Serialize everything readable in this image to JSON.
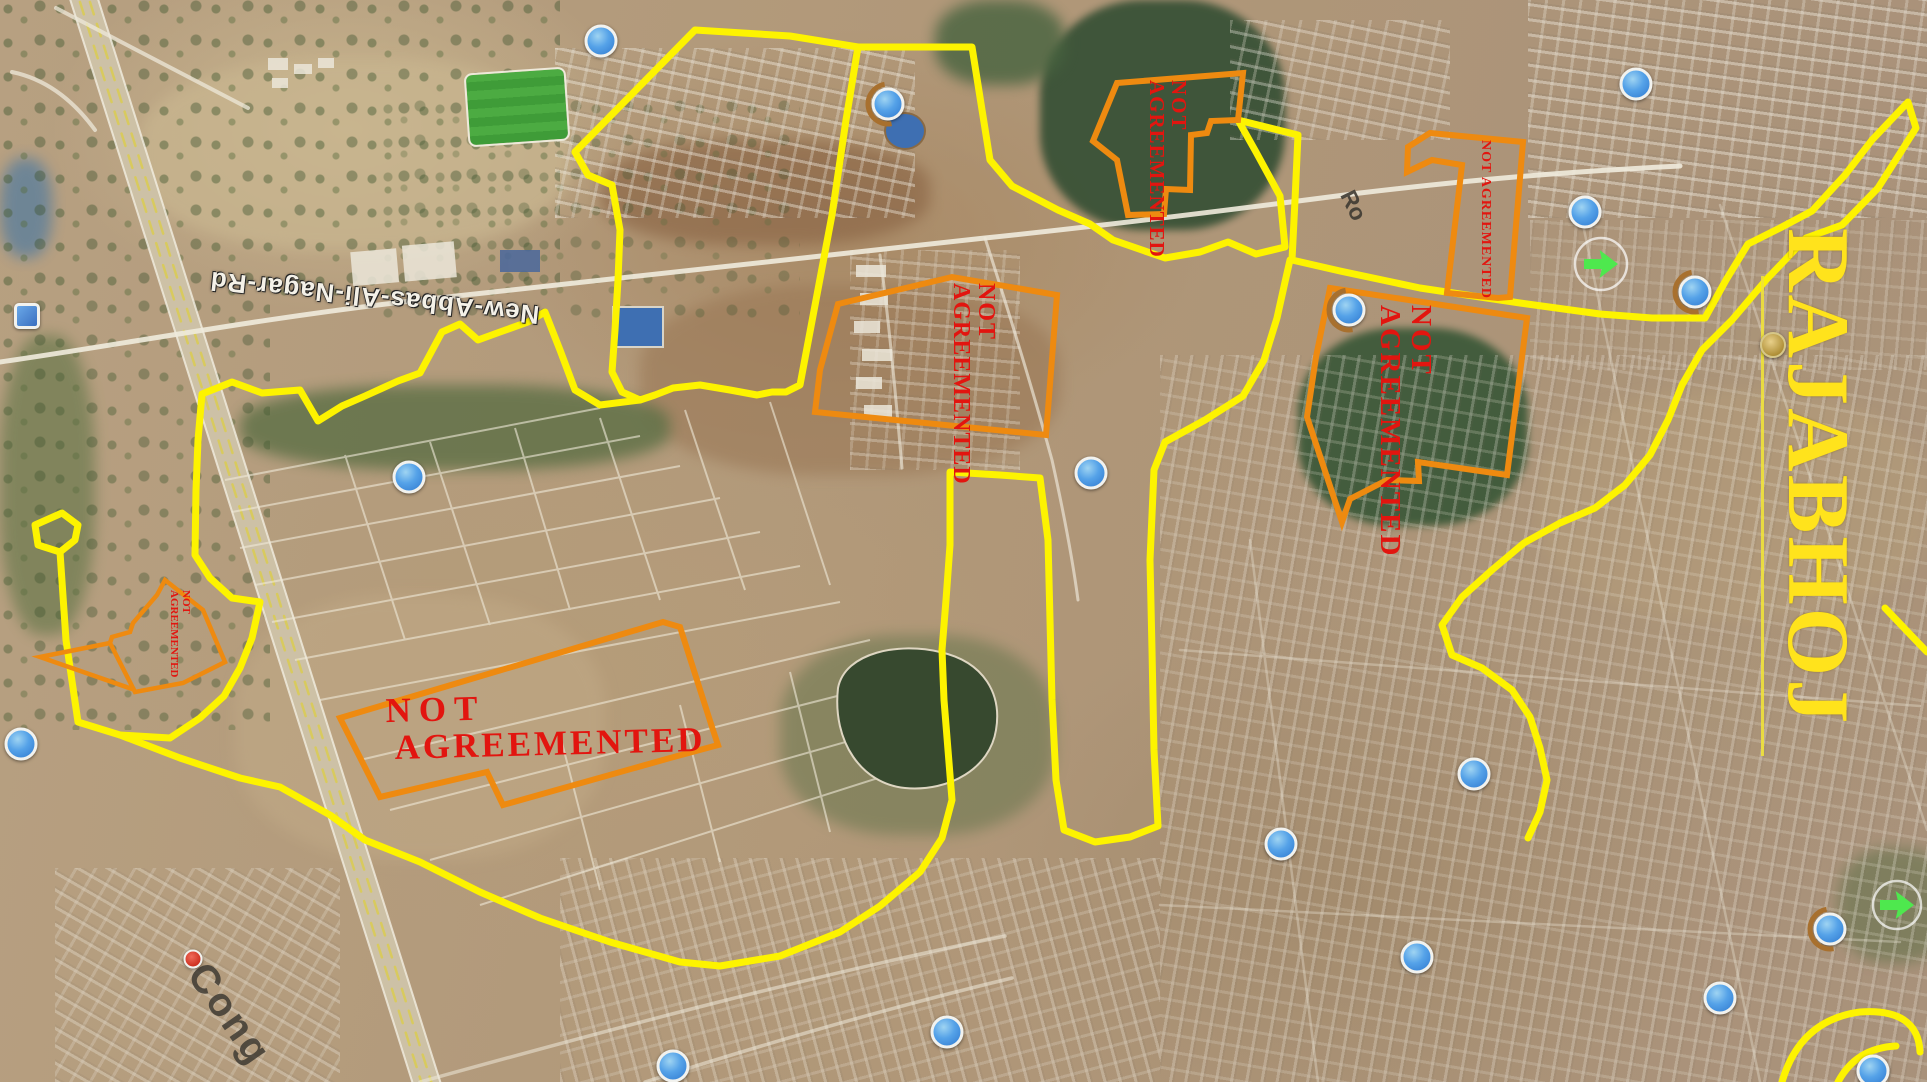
{
  "map_overlay": {
    "region_label": "RAJABHOJ",
    "road_label": "New-Abbas-Ali-Nagar-Rd",
    "road_label_partial": "Ro",
    "place_label_partial": "Cong",
    "annotation": {
      "line1": "NOT",
      "line2": "AGREEMENTED",
      "full": "NOT AGREEMENTED"
    },
    "zones": [
      {
        "id": "southwest-large",
        "orientation": "horizontal"
      },
      {
        "id": "center-field",
        "orientation": "vertical"
      },
      {
        "id": "north-field",
        "orientation": "vertical"
      },
      {
        "id": "northeast-strip",
        "orientation": "vertical"
      },
      {
        "id": "east-field",
        "orientation": "vertical"
      },
      {
        "id": "west-small",
        "orientation": "vertical"
      }
    ],
    "colors": {
      "boundary_yellow": "#fdf300",
      "zone_outline_orange": "#ee8a10",
      "annotation_red": "#e2150f",
      "region_label_yellow": "#ffe31c",
      "road_label_white": "#f4f1e8"
    },
    "markers": {
      "blue_place_count": 17,
      "green_park_count": 2,
      "gold_circle_count": 1,
      "red_dot_count": 1,
      "blue_square_count": 1
    }
  }
}
